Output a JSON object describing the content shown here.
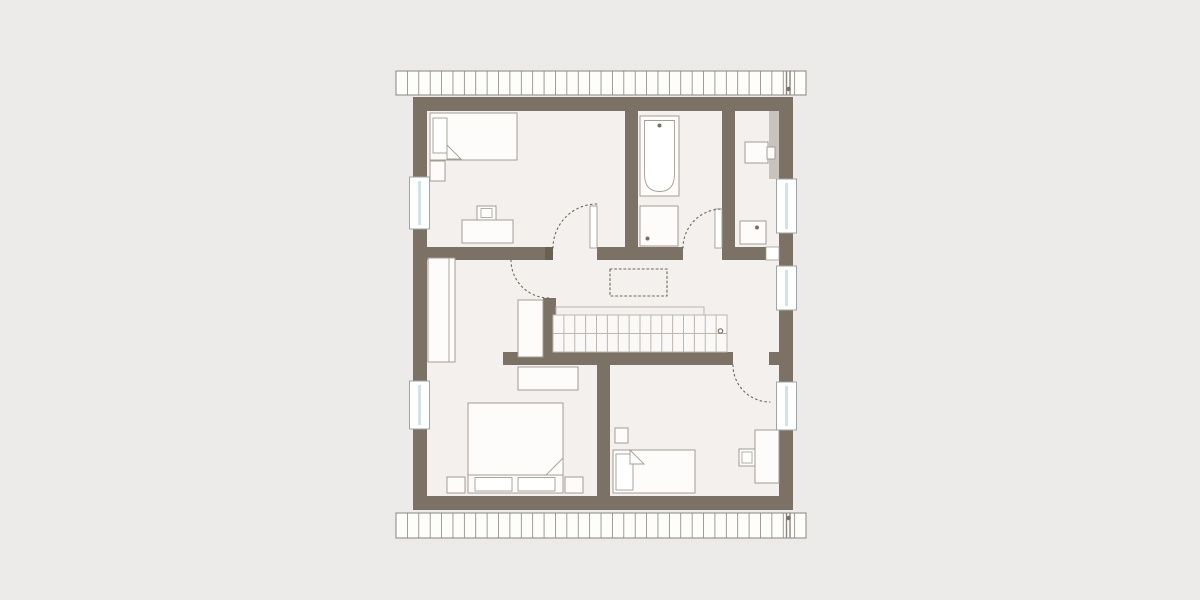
{
  "canvas": {
    "width": 1200,
    "height": 600
  },
  "colors": {
    "bg": "#edebe9",
    "floor": "#f3f0ee",
    "wall": "#7b7164",
    "jamb": "#695f53",
    "furnStroke": "#a39d94",
    "furnFill": "#fdfcfb",
    "stairStroke": "#bcb6ae",
    "stairFill": "#faf9f8",
    "hatchStroke": "#8b857c",
    "hatchFill": "#fdfdfc",
    "white": "#ffffff",
    "glass": "#cfe3e9",
    "winStroke": "#9fa5a5",
    "grayStrip": "#c9c3bd",
    "dash": "#6f675c",
    "dot": "#767067"
  },
  "layers": [
    {
      "name": "background",
      "shapes": [
        {
          "name": "page-background",
          "t": "rect",
          "x": 0,
          "y": 0,
          "w": 1200,
          "h": 600,
          "f": "bg"
        },
        {
          "name": "interior-floor",
          "t": "rect",
          "x": 427,
          "y": 111,
          "w": 352,
          "h": 385,
          "f": "floor"
        }
      ]
    },
    {
      "name": "roof-edge-strips",
      "shapes": [
        {
          "name": "roof-strip-top",
          "t": "rect",
          "x": 396,
          "y": 71,
          "w": 410,
          "h": 24,
          "f": "hatchFill",
          "s": "hatchStroke",
          "sw": 1
        },
        {
          "name": "roof-strip-top-hatch",
          "t": "vlines",
          "x": 396,
          "y": 71,
          "h": 24,
          "count": 35,
          "spacing": 11.39,
          "s": "hatchStroke",
          "sw": 0.8
        },
        {
          "name": "roof-strip-top-divider-a",
          "t": "line",
          "x1": 786.5,
          "y1": 71,
          "x2": 786.5,
          "y2": 95,
          "s": "hatchStroke",
          "sw": 1.4
        },
        {
          "name": "roof-strip-top-divider-b",
          "t": "line",
          "x1": 790,
          "y1": 71,
          "x2": 790,
          "y2": 95,
          "s": "hatchStroke",
          "sw": 1.4
        },
        {
          "name": "roof-strip-top-marker",
          "t": "circle",
          "cx": 788.5,
          "cy": 89,
          "r": 2.2,
          "f": "dot"
        },
        {
          "name": "roof-strip-bottom",
          "t": "rect",
          "x": 396,
          "y": 513,
          "w": 410,
          "h": 25,
          "f": "hatchFill",
          "s": "hatchStroke",
          "sw": 1
        },
        {
          "name": "roof-strip-bottom-hatch",
          "t": "vlines",
          "x": 396,
          "y": 513,
          "h": 25,
          "count": 35,
          "spacing": 11.39,
          "s": "hatchStroke",
          "sw": 0.8
        },
        {
          "name": "roof-strip-bottom-divider-a",
          "t": "line",
          "x1": 786.5,
          "y1": 513,
          "x2": 786.5,
          "y2": 538,
          "s": "hatchStroke",
          "sw": 1.4
        },
        {
          "name": "roof-strip-bottom-divider-b",
          "t": "line",
          "x1": 790,
          "y1": 513,
          "x2": 790,
          "y2": 538,
          "s": "hatchStroke",
          "sw": 1.4
        },
        {
          "name": "roof-strip-bottom-marker",
          "t": "circle",
          "cx": 788.5,
          "cy": 518,
          "r": 2.2,
          "f": "dot"
        }
      ]
    },
    {
      "name": "walls",
      "shapes": [
        {
          "name": "outer-wall-top",
          "t": "rect",
          "x": 413,
          "y": 97,
          "w": 380,
          "h": 14,
          "f": "wall"
        },
        {
          "name": "outer-wall-bottom",
          "t": "rect",
          "x": 413,
          "y": 496,
          "w": 380,
          "h": 14,
          "f": "wall"
        },
        {
          "name": "outer-wall-left",
          "t": "rect",
          "x": 413,
          "y": 97,
          "w": 14,
          "h": 413,
          "f": "wall"
        },
        {
          "name": "outer-wall-right",
          "t": "rect",
          "x": 779,
          "y": 97,
          "w": 14,
          "h": 413,
          "f": "wall"
        },
        {
          "name": "wall-bed1-bath",
          "t": "rect",
          "x": 625,
          "y": 111,
          "w": 13,
          "h": 149,
          "f": "wall"
        },
        {
          "name": "wall-bath-room2",
          "t": "rect",
          "x": 722,
          "y": 111,
          "w": 13,
          "h": 136,
          "f": "wall"
        },
        {
          "name": "wall-hall-top-a",
          "t": "rect",
          "x": 427,
          "y": 247,
          "w": 126,
          "h": 13,
          "f": "wall"
        },
        {
          "name": "wall-hall-top-a-jamb",
          "t": "rect",
          "x": 545,
          "y": 247,
          "w": 8,
          "h": 13,
          "f": "jamb"
        },
        {
          "name": "wall-hall-top-b",
          "t": "rect",
          "x": 597,
          "y": 247,
          "w": 86,
          "h": 13,
          "f": "wall"
        },
        {
          "name": "wall-hall-top-c",
          "t": "rect",
          "x": 722,
          "y": 247,
          "w": 44,
          "h": 13,
          "f": "wall"
        },
        {
          "name": "door-leaf-room2",
          "t": "rect",
          "x": 766,
          "y": 247,
          "w": 13,
          "h": 13,
          "f": "white",
          "s": "furnStroke",
          "sw": 0.8
        },
        {
          "name": "wall-stair-stub",
          "t": "rect",
          "x": 543,
          "y": 298,
          "w": 13,
          "h": 59,
          "f": "wall"
        },
        {
          "name": "wall-hall-bottom",
          "t": "rect",
          "x": 503,
          "y": 352,
          "w": 230,
          "h": 13,
          "f": "wall"
        },
        {
          "name": "wall-hall-bottom-stub",
          "t": "rect",
          "x": 769,
          "y": 352,
          "w": 10,
          "h": 13,
          "f": "wall"
        },
        {
          "name": "wall-bedrooms-divider",
          "t": "rect",
          "x": 597,
          "y": 365,
          "w": 13,
          "h": 131,
          "f": "wall"
        }
      ]
    },
    {
      "name": "windows",
      "shapes": [
        {
          "name": "window-left-1",
          "t": "rect",
          "x": 409.5,
          "y": 177,
          "w": 20,
          "h": 52,
          "f": "white",
          "s": "winStroke",
          "sw": 1
        },
        {
          "name": "window-left-1-glass",
          "t": "rect",
          "x": 418,
          "y": 181,
          "w": 3,
          "h": 44,
          "f": "glass"
        },
        {
          "name": "window-left-2",
          "t": "rect",
          "x": 409.5,
          "y": 381,
          "w": 20,
          "h": 48,
          "f": "white",
          "s": "winStroke",
          "sw": 1
        },
        {
          "name": "window-left-2-glass",
          "t": "rect",
          "x": 418,
          "y": 385,
          "w": 3,
          "h": 40,
          "f": "glass"
        },
        {
          "name": "window-right-1",
          "t": "rect",
          "x": 776.5,
          "y": 179,
          "w": 20,
          "h": 54,
          "f": "white",
          "s": "winStroke",
          "sw": 1
        },
        {
          "name": "window-right-1-glass",
          "t": "rect",
          "x": 785,
          "y": 183,
          "w": 3,
          "h": 46,
          "f": "glass"
        },
        {
          "name": "window-right-2",
          "t": "rect",
          "x": 776.5,
          "y": 266,
          "w": 20,
          "h": 44,
          "f": "white",
          "s": "winStroke",
          "sw": 1
        },
        {
          "name": "window-right-2-glass",
          "t": "rect",
          "x": 785,
          "y": 270,
          "w": 3,
          "h": 36,
          "f": "glass"
        },
        {
          "name": "window-right-3",
          "t": "rect",
          "x": 776.5,
          "y": 382,
          "w": 20,
          "h": 48,
          "f": "white",
          "s": "winStroke",
          "sw": 1
        },
        {
          "name": "window-right-3-glass",
          "t": "rect",
          "x": 785,
          "y": 386,
          "w": 3,
          "h": 40,
          "f": "glass"
        }
      ]
    },
    {
      "name": "stairs",
      "shapes": [
        {
          "name": "stair-rail",
          "t": "path",
          "d": "M556,315 L556,307 L704,307 L704,315",
          "s": "stairStroke",
          "sw": 1
        },
        {
          "name": "stair-box",
          "t": "rect",
          "x": 553,
          "y": 315,
          "w": 174,
          "h": 37,
          "f": "stairFill",
          "s": "stairStroke",
          "sw": 1
        },
        {
          "name": "stair-midline",
          "t": "line",
          "x1": 553,
          "y1": 333.5,
          "x2": 727,
          "y2": 333.5,
          "s": "stairStroke",
          "sw": 1
        },
        {
          "name": "stair-treads",
          "t": "vlines",
          "x": 553,
          "y": 315,
          "h": 37,
          "count": 15,
          "spacing": 10.875,
          "s": "stairStroke",
          "sw": 1
        },
        {
          "name": "stair-marker",
          "t": "circle",
          "cx": 720.5,
          "cy": 331,
          "r": 2.2,
          "f": "none",
          "s": "dot",
          "sw": 1.2
        }
      ]
    },
    {
      "name": "fixtures-bathroom",
      "shapes": [
        {
          "name": "bathtub",
          "t": "rect",
          "x": 640,
          "y": 116,
          "w": 39,
          "h": 80,
          "f": "furnFill",
          "s": "furnStroke",
          "sw": 1
        },
        {
          "name": "bathtub-basin",
          "t": "path",
          "d": "M644.5,120.5 L674.5,120.5 L674.5,174 Q674.5,191.5 659.5,191.5 Q644.5,191.5 644.5,174 Z",
          "f": "white",
          "s": "furnStroke",
          "sw": 0.9
        },
        {
          "name": "bathtub-faucet",
          "t": "circle",
          "cx": 659.5,
          "cy": 125.5,
          "r": 2,
          "f": "dot"
        },
        {
          "name": "shower-tray",
          "t": "rect",
          "x": 640,
          "y": 206,
          "w": 38,
          "h": 40,
          "f": "furnFill",
          "s": "furnStroke",
          "sw": 1
        },
        {
          "name": "shower-drain",
          "t": "circle",
          "cx": 647.5,
          "cy": 238.5,
          "r": 2,
          "f": "dot"
        }
      ]
    },
    {
      "name": "room2-top-right",
      "shapes": [
        {
          "name": "knee-wall-strip",
          "t": "rect",
          "x": 769,
          "y": 111,
          "w": 10,
          "h": 68,
          "f": "grayStrip"
        },
        {
          "name": "desk-room2",
          "t": "rect",
          "x": 745,
          "y": 142,
          "w": 23,
          "h": 21,
          "f": "furnFill",
          "s": "furnStroke",
          "sw": 1
        },
        {
          "name": "chair-room2",
          "t": "rect",
          "x": 767,
          "y": 147,
          "w": 8,
          "h": 12,
          "f": "furnFill",
          "s": "furnStroke",
          "sw": 1
        },
        {
          "name": "washbasin-room2",
          "t": "rect",
          "x": 740,
          "y": 221,
          "w": 26,
          "h": 23,
          "f": "furnFill",
          "s": "furnStroke",
          "sw": 1
        },
        {
          "name": "washbasin-room2-drain",
          "t": "circle",
          "cx": 757,
          "cy": 227.5,
          "r": 2,
          "f": "dot"
        }
      ]
    },
    {
      "name": "furniture-bedroom-top-left",
      "shapes": [
        {
          "name": "bed-child",
          "t": "rect",
          "x": 430,
          "y": 113,
          "w": 87,
          "h": 47,
          "f": "furnFill",
          "s": "furnStroke",
          "sw": 1
        },
        {
          "name": "bed-child-pillow",
          "t": "rect",
          "x": 433,
          "y": 118,
          "w": 14,
          "h": 35,
          "f": "white",
          "s": "furnStroke",
          "sw": 0.9
        },
        {
          "name": "bed-child-fold",
          "t": "poly",
          "pts": "447,145 461,159 447,159",
          "f": "white",
          "s": "furnStroke",
          "sw": 0.9
        },
        {
          "name": "nightstand-child",
          "t": "rect",
          "x": 430,
          "y": 161,
          "w": 15,
          "h": 20,
          "f": "furnFill",
          "s": "furnStroke",
          "sw": 1
        },
        {
          "name": "desk-child",
          "t": "rect",
          "x": 462,
          "y": 220,
          "w": 51,
          "h": 23,
          "f": "furnFill",
          "s": "furnStroke",
          "sw": 1
        },
        {
          "name": "chair-child",
          "t": "rect",
          "x": 477,
          "y": 206,
          "w": 19,
          "h": 14,
          "f": "furnFill",
          "s": "furnStroke",
          "sw": 1
        },
        {
          "name": "chair-child-seat",
          "t": "rect",
          "x": 481,
          "y": 208.5,
          "w": 11,
          "h": 9,
          "f": "white",
          "s": "furnStroke",
          "sw": 0.8
        }
      ]
    },
    {
      "name": "furniture-hall",
      "shapes": [
        {
          "name": "wardrobe-hall",
          "t": "rect",
          "x": 428,
          "y": 258,
          "w": 27,
          "h": 104,
          "f": "furnFill",
          "s": "furnStroke",
          "sw": 1
        },
        {
          "name": "wardrobe-hall-divider",
          "t": "line",
          "x1": 449,
          "y1": 258,
          "x2": 449,
          "y2": 362,
          "s": "furnStroke",
          "sw": 0.9
        },
        {
          "name": "closet-alcove",
          "t": "rect",
          "x": 518,
          "y": 300,
          "w": 25,
          "h": 57,
          "f": "furnFill",
          "s": "furnStroke",
          "sw": 1
        },
        {
          "name": "door-leaf-bedroom1",
          "t": "rect",
          "x": 590,
          "y": 206,
          "w": 7,
          "h": 42,
          "f": "white",
          "s": "furnStroke",
          "sw": 0.9
        },
        {
          "name": "door-leaf-bath",
          "t": "rect",
          "x": 715,
          "y": 209,
          "w": 7,
          "h": 39,
          "f": "white",
          "s": "furnStroke",
          "sw": 0.9
        }
      ]
    },
    {
      "name": "furniture-bedroom-bottom-left",
      "shapes": [
        {
          "name": "dresser-main",
          "t": "rect",
          "x": 518,
          "y": 367,
          "w": 60,
          "h": 23,
          "f": "furnFill",
          "s": "furnStroke",
          "sw": 1
        },
        {
          "name": "bed-main",
          "t": "rect",
          "x": 468,
          "y": 403,
          "w": 95,
          "h": 90,
          "f": "furnFill",
          "s": "furnStroke",
          "sw": 1
        },
        {
          "name": "bed-main-divider",
          "t": "line",
          "x1": 468,
          "y1": 475,
          "x2": 563,
          "y2": 475,
          "s": "furnStroke",
          "sw": 0.9
        },
        {
          "name": "bed-main-fold",
          "t": "poly",
          "pts": "563,458 563,475 546,475",
          "f": "white",
          "s": "furnStroke",
          "sw": 0.9
        },
        {
          "name": "bed-main-pillow-left",
          "t": "rect",
          "x": 475,
          "y": 477.5,
          "w": 37,
          "h": 13.5,
          "f": "white",
          "s": "furnStroke",
          "sw": 0.9
        },
        {
          "name": "bed-main-pillow-right",
          "t": "rect",
          "x": 518,
          "y": 477.5,
          "w": 37,
          "h": 13.5,
          "f": "white",
          "s": "furnStroke",
          "sw": 0.9
        },
        {
          "name": "nightstand-main-left",
          "t": "rect",
          "x": 447,
          "y": 477,
          "w": 18,
          "h": 16,
          "f": "furnFill",
          "s": "furnStroke",
          "sw": 1
        },
        {
          "name": "nightstand-main-right",
          "t": "rect",
          "x": 565,
          "y": 477,
          "w": 18,
          "h": 16,
          "f": "furnFill",
          "s": "furnStroke",
          "sw": 1
        }
      ]
    },
    {
      "name": "furniture-bedroom-bottom-right",
      "shapes": [
        {
          "name": "nightstand-guest",
          "t": "rect",
          "x": 615,
          "y": 428,
          "w": 13,
          "h": 15,
          "f": "furnFill",
          "s": "furnStroke",
          "sw": 1
        },
        {
          "name": "bed-guest",
          "t": "rect",
          "x": 613,
          "y": 450,
          "w": 82,
          "h": 43,
          "f": "furnFill",
          "s": "furnStroke",
          "sw": 1
        },
        {
          "name": "bed-guest-pillow",
          "t": "rect",
          "x": 616,
          "y": 454,
          "w": 17,
          "h": 36,
          "f": "white",
          "s": "furnStroke",
          "sw": 0.9
        },
        {
          "name": "bed-guest-fold",
          "t": "poly",
          "pts": "630,450 644,464 630,464",
          "f": "white",
          "s": "furnStroke",
          "sw": 0.9
        },
        {
          "name": "desk-guest",
          "t": "rect",
          "x": 755,
          "y": 430,
          "w": 24,
          "h": 53,
          "f": "furnFill",
          "s": "furnStroke",
          "sw": 1
        },
        {
          "name": "chair-guest",
          "t": "rect",
          "x": 739,
          "y": 449,
          "w": 16,
          "h": 17,
          "f": "furnFill",
          "s": "furnStroke",
          "sw": 1
        },
        {
          "name": "chair-guest-seat",
          "t": "rect",
          "x": 742,
          "y": 452,
          "w": 10,
          "h": 11,
          "f": "white",
          "s": "furnStroke",
          "sw": 0.8
        }
      ]
    },
    {
      "name": "door-swings",
      "shapes": [
        {
          "name": "door-arc-bedroom1",
          "t": "path",
          "d": "M553,248 A44,44 0 0 1 597,204",
          "s": "dash",
          "sw": 1.1,
          "dash": "1.6,3.2"
        },
        {
          "name": "door-arc-bath",
          "t": "path",
          "d": "M683,248 A39,39 0 0 1 722,209",
          "s": "dash",
          "sw": 1.1,
          "dash": "1.6,3.2"
        },
        {
          "name": "door-arc-alcove",
          "t": "path",
          "d": "M511,260 A38,38 0 0 0 549,298",
          "s": "dash",
          "sw": 1.1,
          "dash": "1.6,3.2"
        },
        {
          "name": "door-arc-bedroom2",
          "t": "path",
          "d": "M733,365 A37,37 0 0 0 770,402",
          "s": "dash",
          "sw": 1.1,
          "dash": "1.6,3.2"
        },
        {
          "name": "void-opening-outline",
          "t": "rect",
          "x": 610,
          "y": 269,
          "w": 57,
          "h": 27,
          "f": "none",
          "s": "dash",
          "sw": 1.1,
          "dash": "2,2.6"
        }
      ]
    }
  ]
}
